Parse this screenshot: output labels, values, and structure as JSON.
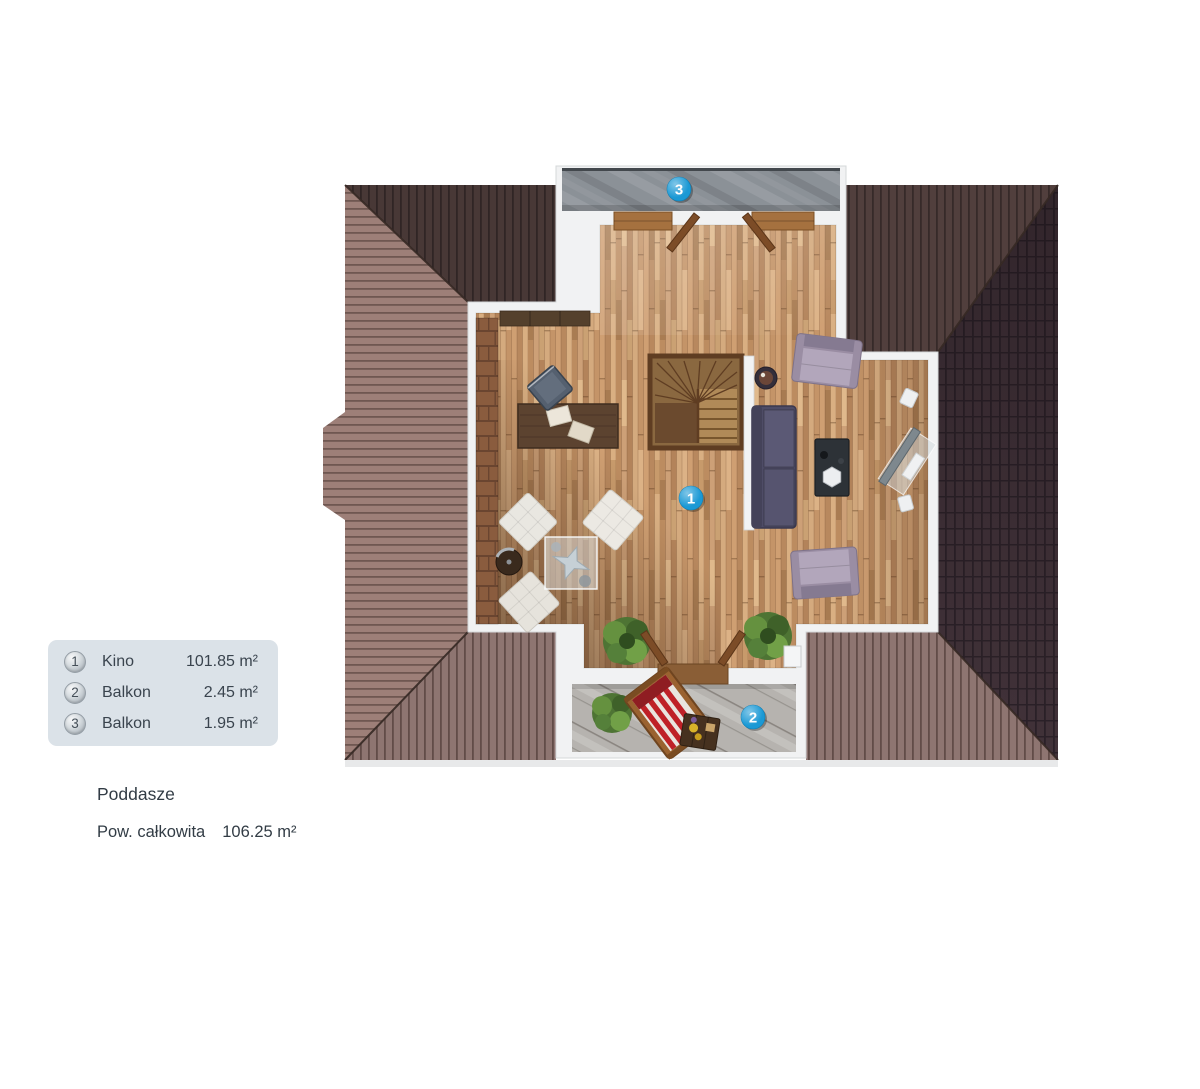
{
  "legend": {
    "items": [
      {
        "num": "1",
        "name": "Kino",
        "area": "101.85 m²"
      },
      {
        "num": "2",
        "name": "Balkon",
        "area": "2.45 m²"
      },
      {
        "num": "3",
        "name": "Balkon",
        "area": "1.95 m²"
      }
    ]
  },
  "labels": {
    "floor_title": "Poddasze",
    "total_label": "Pow. całkowita",
    "total_area": "106.25 m²"
  },
  "plan": {
    "markers": [
      {
        "label": "1"
      },
      {
        "label": "2"
      },
      {
        "label": "3"
      }
    ]
  },
  "colors": {
    "marker_blue": "#1b99d5",
    "legend_bg": "#dbe2e8",
    "text": "#3a444e",
    "roof_left": "#9d7f78",
    "roof_top": "#513f3d",
    "roof_right": "#413239",
    "roof_bottom": "#8e7571",
    "floor_wood": "#c2946a",
    "stone_dark": "#8b9197",
    "stone_light": "#b6b3af"
  }
}
